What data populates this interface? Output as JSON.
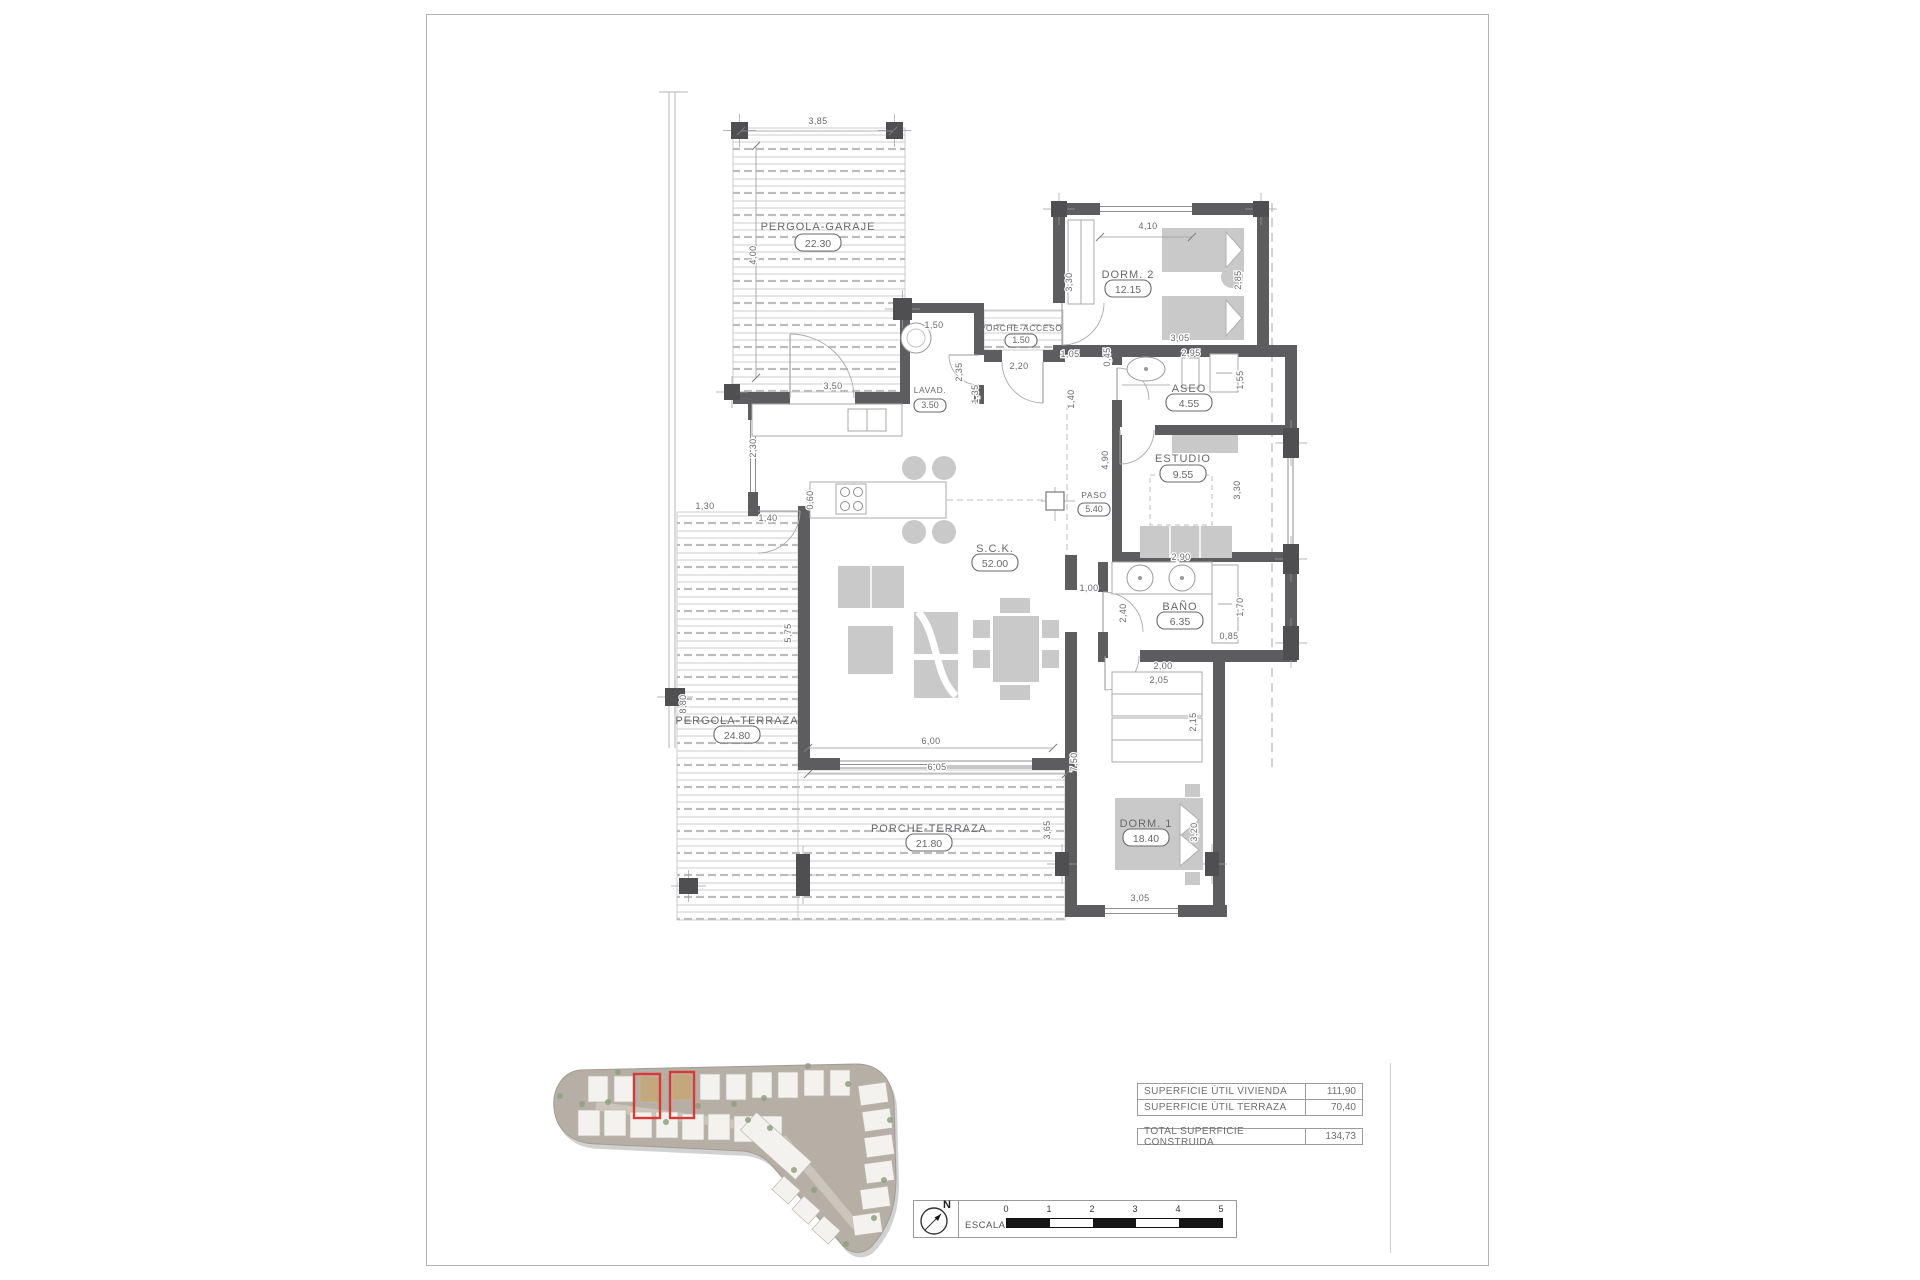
{
  "rooms": {
    "pergola_garaje": {
      "label": "PERGOLA-GARAJE",
      "area": "22.30"
    },
    "porche_acceso": {
      "label": "PORCHE-ACCESO",
      "area": "1.50"
    },
    "lavad": {
      "label": "LAVAD.",
      "area": "3.50"
    },
    "dorm2": {
      "label": "DORM. 2",
      "area": "12.15"
    },
    "aseo": {
      "label": "ASEO",
      "area": "4.55"
    },
    "estudio": {
      "label": "ESTUDIO",
      "area": "9.55"
    },
    "paso": {
      "label": "PASO",
      "area": "5.40"
    },
    "sck": {
      "label": "S.C.K.",
      "area": "52.00"
    },
    "bano": {
      "label": "BAÑO",
      "area": "6.35"
    },
    "pergola_terraza": {
      "label": "PERGOLA-TERRAZA",
      "area": "24.80"
    },
    "porche_terraza": {
      "label": "PORCHE-TERRAZA",
      "area": "21.80"
    },
    "dorm1": {
      "label": "DORM. 1",
      "area": "18.40"
    }
  },
  "dimensions": {
    "d_385": "3,85",
    "d_400": "4,00",
    "d_150": "1,50",
    "d_235": "2,35",
    "d_135": "1,35",
    "d_350": "3,50",
    "d_220": "2,20",
    "d_105": "1,05",
    "d_045": "0,45",
    "d_140a": "1,40",
    "d_330a": "3,30",
    "d_410": "4,10",
    "d_285": "2,85",
    "d_305a": "3,05",
    "d_295": "2,95",
    "d_155": "1,55",
    "d_490": "4,90",
    "d_330b": "3,30",
    "d_290": "2,90",
    "d_060": "0,60",
    "d_230": "2,30",
    "d_130": "1,30",
    "d_140b": "1,40",
    "d_575": "5,75",
    "d_880": "8,80",
    "d_600": "6,00",
    "d_605": "6,05",
    "d_100": "1,00",
    "d_240": "2,40",
    "d_170": "1,70",
    "d_085": "0,85",
    "d_200": "2,00",
    "d_205": "2,05",
    "d_215": "2,15",
    "d_750": "7,50",
    "d_365": "3,65",
    "d_320": "3,20",
    "d_305b": "3,05"
  },
  "summary_table": {
    "rows": [
      {
        "label": "SUPERFICIE ÚTIL VIVIENDA",
        "value": "111,90"
      },
      {
        "label": "SUPERFICIE ÚTIL TERRAZA",
        "value": "70,40"
      }
    ],
    "total_row": {
      "label": "TOTAL SUPERFICIE CONSTRUIDA",
      "value": "134,73"
    }
  },
  "scale_bar": {
    "label": "ESCALA :",
    "ticks": [
      "0",
      "1",
      "2",
      "3",
      "4",
      "5"
    ]
  },
  "north": {
    "label": "N"
  },
  "colors": {
    "wall": "#5d5d5f",
    "column": "#4f4f51",
    "furniture": "#c9c9c9",
    "drawing_text": "#68696b",
    "deck_line": "#cdcdcd",
    "dashed_line": "#a6a6a6",
    "red_highlight": "#d93a35",
    "site_ground": "#b6afa6",
    "house": "#f4f2ee",
    "house_beige": "#c5a77e",
    "green": "#8fa07e"
  }
}
